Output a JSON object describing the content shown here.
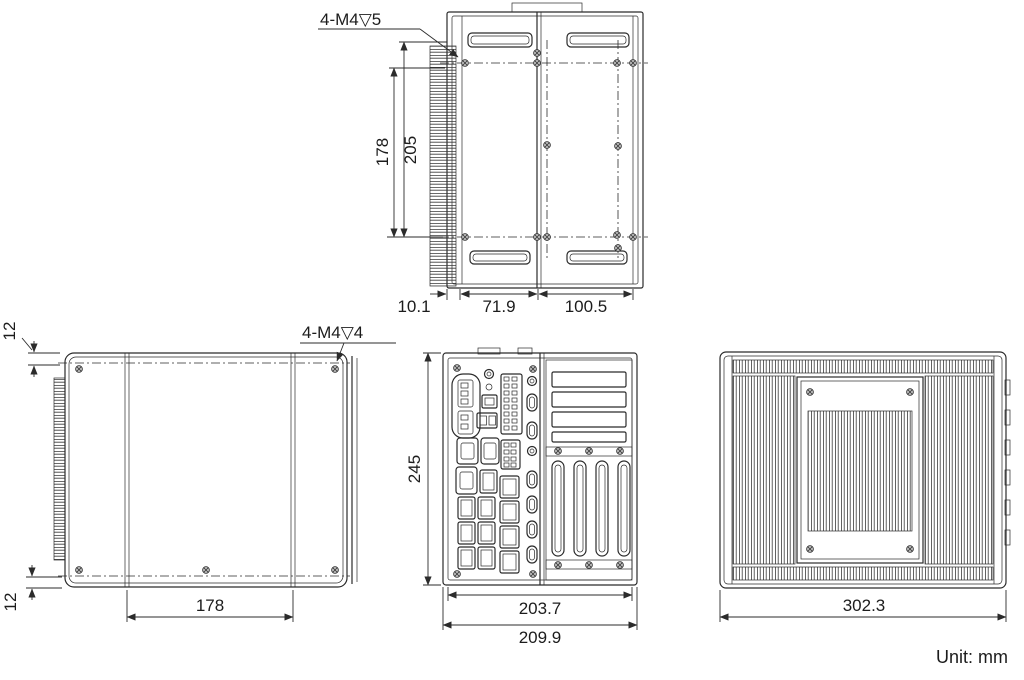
{
  "meta": {
    "unit_note": "Unit: mm"
  },
  "top_view": {
    "thread_label": "4-M4▽5",
    "dim_depth_outer": "178",
    "dim_depth_inner": "205",
    "dim_bottom": [
      "10.1",
      "71.9",
      "100.5"
    ]
  },
  "left_view": {
    "thread_label": "4-M4▽4",
    "dim_edge_top": "12",
    "dim_edge_bottom": "12",
    "dim_hole_spacing": "178"
  },
  "front_view": {
    "dim_height": "245",
    "dim_width_inner": "203.7",
    "dim_width_outer": "209.9"
  },
  "right_view": {
    "dim_depth": "302.3"
  }
}
